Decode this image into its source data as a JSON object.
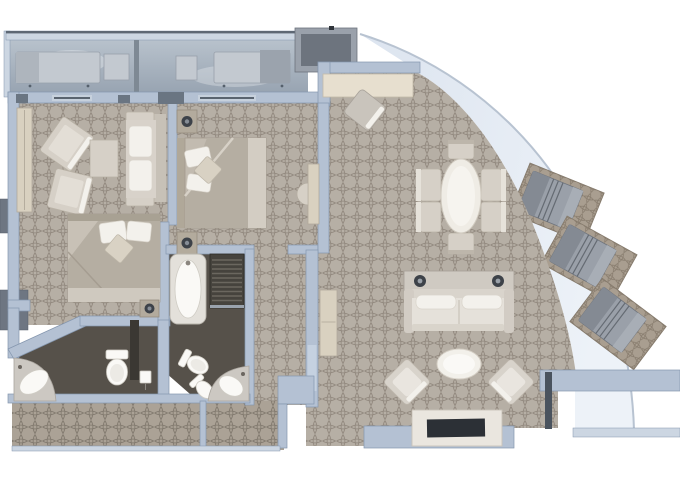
{
  "colors": {
    "white": "#ffffff",
    "wall": "#b4c1d3",
    "wallEdge": "#8496ae",
    "wallLight": "#ccd6e2",
    "wallDark": "#6e7682",
    "carpet": "#b6afa5",
    "carpetLine": "#8d8479",
    "carpetDark": "#aba296",
    "carpetDarkLine": "#7f776c",
    "mat": "#a99e90",
    "matLine": "#84796b",
    "bathFloor": "#56514a",
    "bathPartition": "#3b3833",
    "deckTop": "#b9c3cd",
    "deckBottom": "#96a2b0",
    "band": "#dce4ef",
    "bandLight": "#edf2f8",
    "cream": "#d6d0c7",
    "creamDark": "#b9b2a6",
    "tan": "#e7dfcf",
    "woodTan": "#d9d1c0",
    "fixtureWhite": "#faf9f6",
    "furnWhite": "#f3f1ec",
    "bedBase": "#c2bbb0",
    "duvet": "#b5aea2",
    "duvetLight": "#d7d1c7",
    "loungerGray": "#9aa0a9",
    "loungerDark": "#848a93",
    "lampDark": "#3d4249",
    "tvDark": "#2c3036",
    "grayChair": "#c9c4bc"
  },
  "plan": {
    "type": "suite-floor-plan",
    "text_visible": false,
    "rooms": [
      {
        "name": "second-bedroom",
        "floor": "patterned-carpet",
        "furniture": [
          "wardrobe",
          "armchair",
          "armchair",
          "side-table",
          "loveseat",
          "double-bed",
          "nightstand-with-lamp"
        ]
      },
      {
        "name": "master-bedroom",
        "floor": "patterned-carpet",
        "furniture": [
          "double-bed",
          "nightstand-with-lamp",
          "nightstand-with-lamp",
          "vanity",
          "stool"
        ]
      },
      {
        "name": "living-dining-room",
        "floor": "patterned-carpet",
        "furniture": [
          "desk",
          "desk-chair",
          "oval-dining-table",
          "dining-chair",
          "dining-chair",
          "dining-chair",
          "dining-chair",
          "dining-chair",
          "dining-chair",
          "console-with-two-lamps",
          "sofa",
          "coffee-table",
          "armchair",
          "armchair",
          "tv-cabinet",
          "tv",
          "hall-cabinet"
        ]
      },
      {
        "name": "master-bathroom",
        "floor": "dark-tile",
        "fixtures": [
          "bathtub",
          "shower",
          "toilet",
          "bidet",
          "corner-sink"
        ]
      },
      {
        "name": "guest-bathroom",
        "floor": "dark-tile",
        "fixtures": [
          "corner-sink",
          "toilet",
          "wall-phone"
        ]
      },
      {
        "name": "entry-hall",
        "floor": "patterned-carpet",
        "furniture": []
      },
      {
        "name": "front-balcony",
        "sections": 2,
        "furniture": [
          "sun-lounger",
          "side-table",
          "side-table",
          "sun-lounger"
        ]
      },
      {
        "name": "curved-side-balcony",
        "furniture": [
          "sun-lounger-on-mat",
          "sun-lounger-on-mat",
          "sun-lounger-on-mat"
        ]
      }
    ]
  }
}
